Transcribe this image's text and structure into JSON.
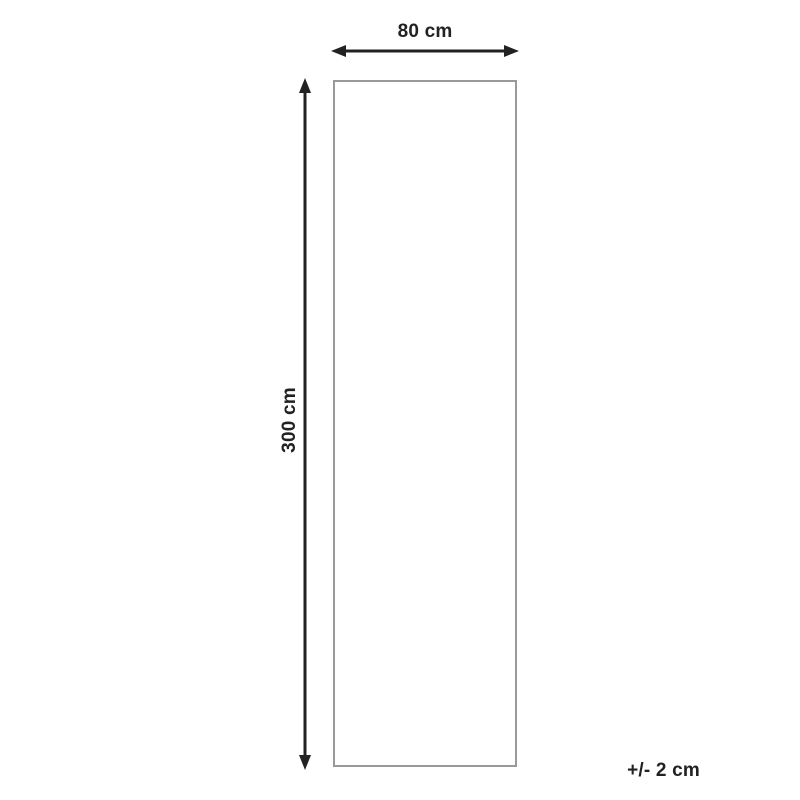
{
  "diagram": {
    "width_label": "80 cm",
    "height_label": "300 cm",
    "tolerance_label": "+/- 2 cm",
    "colors": {
      "arrow": "#222222",
      "outline": "#999999",
      "background": "#ffffff"
    }
  }
}
